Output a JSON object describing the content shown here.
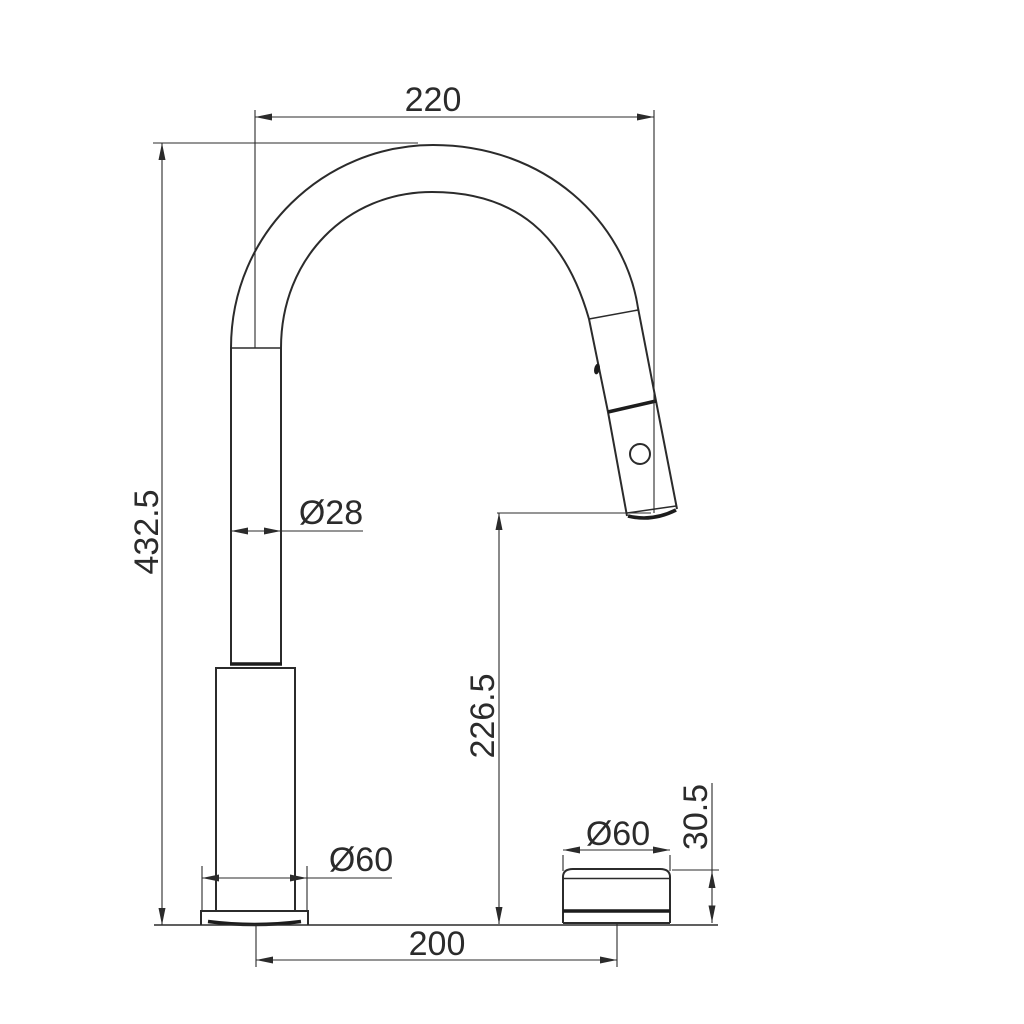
{
  "drawing": {
    "type": "technical-dimension-drawing",
    "subject": "pull-down kitchen faucet side view with separate handle knob",
    "colors": {
      "line": "#2b2b2b",
      "thick_line": "#1c1c1c",
      "background": "#ffffff"
    },
    "dimensions": {
      "spout_reach": "220",
      "overall_height": "432.5",
      "spout_tube_diameter": "Ø28",
      "outlet_height": "226.5",
      "base_flange_diameter": "Ø60",
      "centers_distance": "200",
      "handle_diameter": "Ø60",
      "handle_height": "30.5"
    }
  }
}
